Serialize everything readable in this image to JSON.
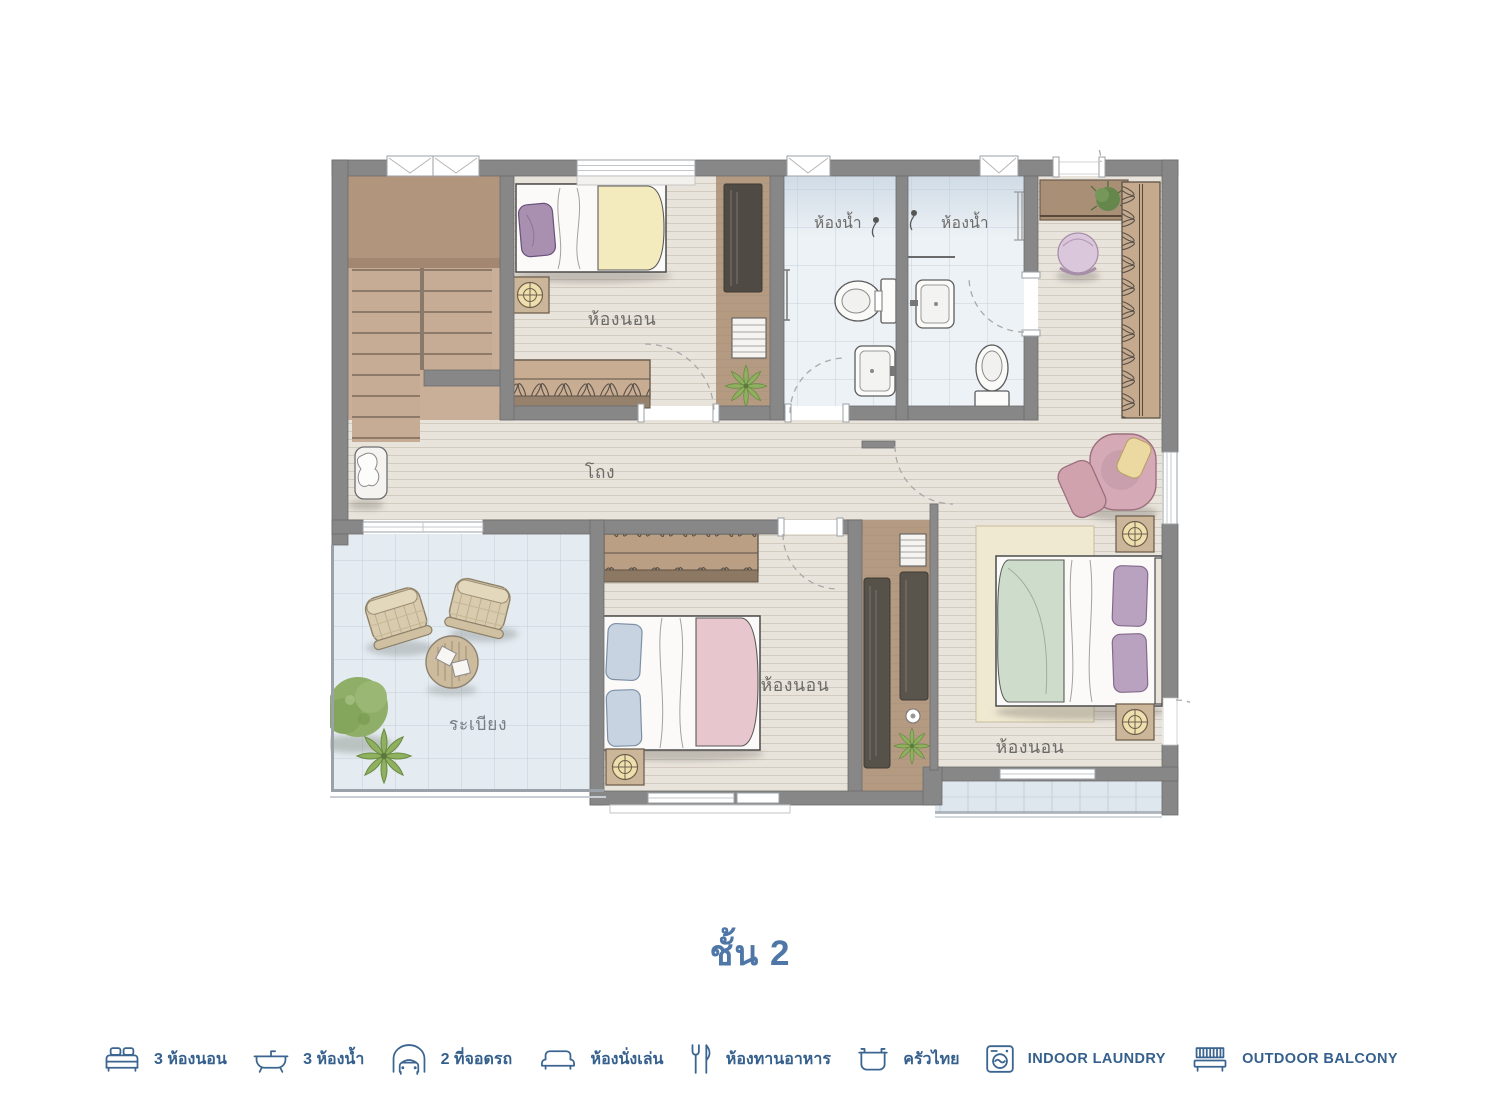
{
  "title": "ชั้น 2",
  "plan": {
    "rooms": {
      "bedroom_top": "ห้องนอน",
      "bathroom_left": "ห้องน้ำ",
      "bathroom_right": "ห้องน้ำ",
      "hall": "โถง",
      "bedroom_middle": "ห้องนอน",
      "bedroom_right": "ห้องนอน",
      "balcony": "ระเบียง"
    }
  },
  "legend": {
    "items": [
      {
        "icon": "bed-icon",
        "label": "3 ห้องนอน"
      },
      {
        "icon": "bathtub-icon",
        "label": "3 ห้องน้ำ"
      },
      {
        "icon": "car-icon",
        "label": "2 ที่จอดรถ"
      },
      {
        "icon": "sofa-icon",
        "label": "ห้องนั่งเล่น"
      },
      {
        "icon": "cutlery-icon",
        "label": "ห้องทานอาหาร"
      },
      {
        "icon": "pot-icon",
        "label": "ครัวไทย"
      },
      {
        "icon": "washing-machine-icon",
        "label": "INDOOR LAUNDRY"
      },
      {
        "icon": "bench-icon",
        "label": "OUTDOOR BALCONY"
      }
    ]
  },
  "colors": {
    "accent_blue": "#4e76a6",
    "legend_blue": "#35608d",
    "wall_gray": "#878787"
  }
}
